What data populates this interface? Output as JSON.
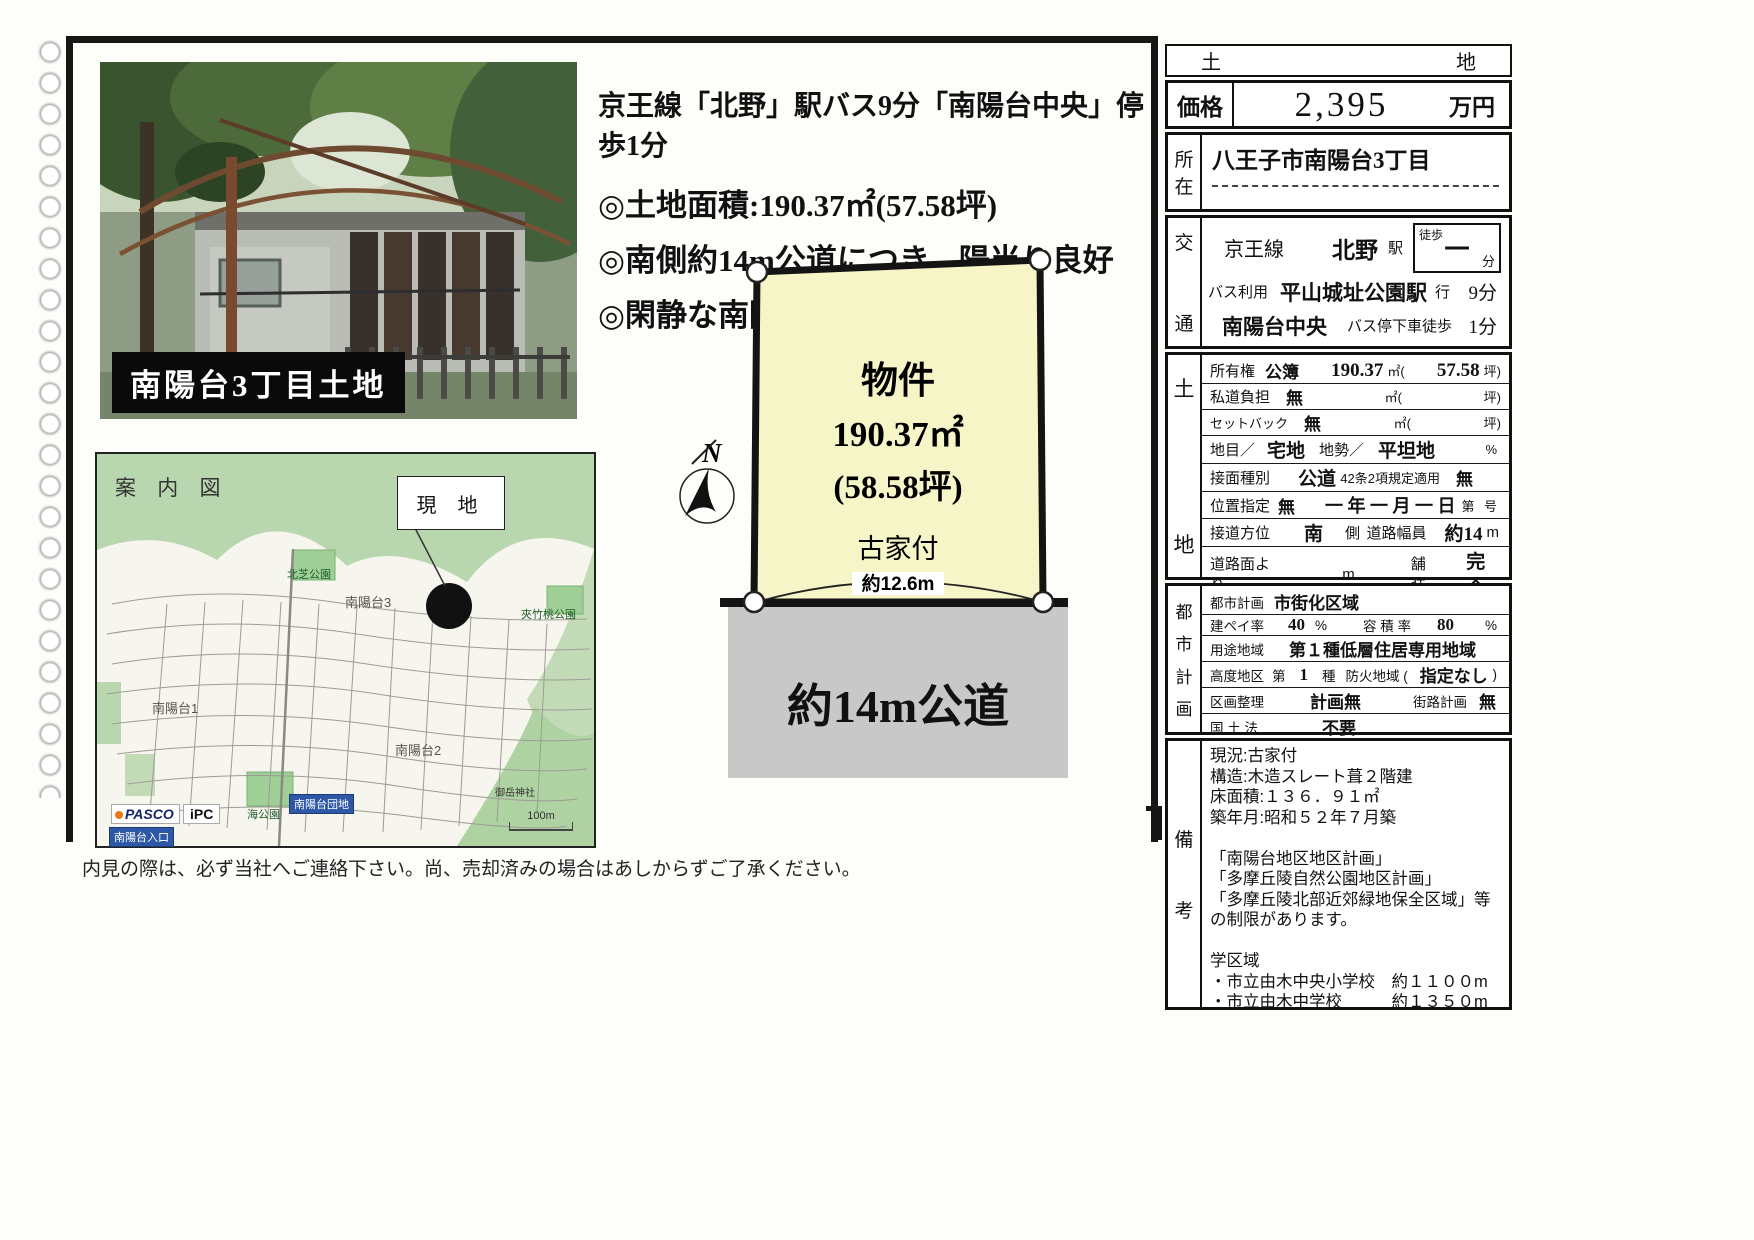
{
  "colors": {
    "plot_fill": "#f5f5c8",
    "road_fill": "#c8c8c8",
    "map_green": "#b9d7ae",
    "chip_blue": "#2e58a6",
    "frame_black": "#161616"
  },
  "page": {
    "disclaimer": "内見の際は、必ず当社へご連絡下さい。尚、売却済みの場合はあしからずご了承ください。"
  },
  "photo": {
    "caption": "南陽台3丁目土地"
  },
  "headline": {
    "access_line": "京王線「北野」駅バス9分「南陽台中央」停歩1分",
    "bullet1": "◎土地面積:190.37㎡(57.58坪)",
    "bullet2": "◎南側約14m公道につき、陽当り良好",
    "bullet3": "◎閑静な南陽台分譲地内"
  },
  "map": {
    "title": "案 内 図",
    "site_callout": "現 地",
    "park_north": "北芝公園",
    "district3": "南陽台3",
    "park_right": "夾竹桃公園",
    "district1": "南陽台1",
    "park_sea": "海公園",
    "bus_danchi": "南陽台団地",
    "district2": "南陽台2",
    "shrine": "御岳神社",
    "logo_pasco": "PASCO",
    "logo_ipc": "iPC",
    "bus_iriguchi": "南陽台入口",
    "scale": "100m"
  },
  "diagram": {
    "compass": "N",
    "plot_title": "物件",
    "plot_area_m2": "190.37㎡",
    "plot_area_tsubo": "(58.58坪)",
    "plot_note": "古家付",
    "frontage": "約12.6m",
    "road": "約14m公道"
  },
  "info": {
    "type_left": "土",
    "type_right": "地",
    "price": {
      "label": "価格",
      "value": "2,395",
      "unit": "万円"
    },
    "location": {
      "label_chars": [
        "所",
        "在"
      ],
      "value": "八王子市南陽台3丁目"
    },
    "access": {
      "label_chars": [
        "交",
        "通"
      ],
      "line_name": "京王線",
      "station": "北野",
      "station_suffix": "駅",
      "walk_label": "徒歩",
      "walk_value": "一",
      "walk_unit": "分",
      "bus_use": "バス利用",
      "bus_route": "平山城址公園駅",
      "bus_route_suffix": "行",
      "bus_time": "9分",
      "bus_stop": "南陽台中央",
      "bus_stop_suffix": "バス停下車徒歩",
      "bus_stop_time": "1分"
    },
    "land": {
      "label_chars": [
        "土",
        "地"
      ],
      "r1": {
        "a": "所有権",
        "b": "公簿",
        "c": "190.37",
        "d": "㎡(",
        "e": "57.58",
        "f": "坪)"
      },
      "r2": {
        "a": "私道負担",
        "b": "無",
        "c": "㎡(",
        "d": "坪)"
      },
      "r3": {
        "a": "セットバック",
        "b": "無",
        "c": "㎡(",
        "d": "坪)"
      },
      "r4": {
        "a": "地目／",
        "b": "宅地",
        "c": "地勢／",
        "d": "平坦地",
        "e": "%"
      },
      "r5": {
        "a": "接面種別",
        "b": "公道",
        "c": "42条2項規定適用",
        "d": "無"
      },
      "r6": {
        "a": "位置指定",
        "b": "無",
        "c": "一 年 一 月 一 日",
        "d": "第",
        "e": "号"
      },
      "r7": {
        "a": "接道方位",
        "b": "南",
        "c": "側",
        "d": "道路幅員",
        "e": "約14",
        "f": "m"
      },
      "r8": {
        "a": "道路面より",
        "b": "m",
        "c": "舗装",
        "d": "完全"
      }
    },
    "city": {
      "label_chars": [
        "都",
        "市",
        "計",
        "画"
      ],
      "r1": {
        "a": "都市計画",
        "b": "市街化区域"
      },
      "r2": {
        "a": "建ペイ率",
        "b": "40",
        "c": "%",
        "d": "容 積 率",
        "e": "80",
        "f": "%"
      },
      "r3": {
        "a": "用途地域",
        "b": "第１種低層住居専用地域"
      },
      "r4": {
        "a": "高度地区",
        "b": "第",
        "c": "1",
        "d": "種",
        "e": "防火地域 (",
        "f": "指定なし",
        "g": ")"
      },
      "r5": {
        "a": "区画整理",
        "b": "計画無",
        "c": "街路計画",
        "d": "無"
      },
      "r6": {
        "a": "国 土 法",
        "b": "不要"
      },
      "r7": {
        "a": "その他法令上の制限 (",
        "b": ")"
      }
    },
    "remarks": {
      "label_chars": [
        "備",
        "考"
      ],
      "lines": [
        "現況:古家付",
        "構造:木造スレート葺２階建",
        "床面積:１３６．９１㎡",
        "築年月:昭和５２年７月築",
        "",
        "「南陽台地区地区計画」",
        "「多摩丘陵自然公園地区計画」",
        "「多摩丘陵北部近郊緑地保全区域」等の",
        "　制限があります。",
        "",
        "学区域",
        "・市立由木中央小学校　約１１００m",
        "・市立由木中学校　　　約１３５０m"
      ]
    }
  }
}
